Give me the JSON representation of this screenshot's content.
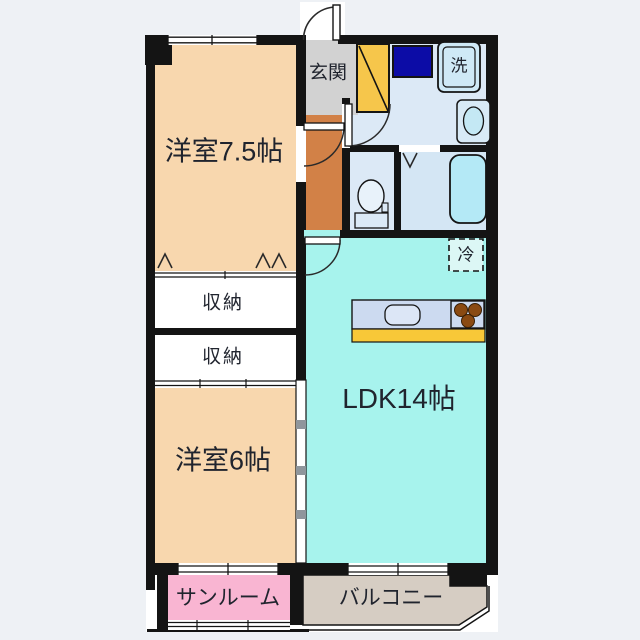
{
  "plan": {
    "type": "apartment-floorplan",
    "rooms": {
      "bedroom_75": {
        "label": "洋室7.5帖",
        "color": "#f8d7ae"
      },
      "entrance": {
        "label": "玄関",
        "color": "#d2d2d2"
      },
      "washer": {
        "label": "洗",
        "color": "#cfe9f6"
      },
      "storage_upper": {
        "label": "収納",
        "color": "#ffffff"
      },
      "storage_lower": {
        "label": "収納",
        "color": "#ffffff"
      },
      "bedroom_6": {
        "label": "洋室6帖",
        "color": "#f8d7ae"
      },
      "ldk": {
        "label": "LDK14帖",
        "color": "#a7f3ed"
      },
      "refrigerator": {
        "label": "冷"
      },
      "sunroom": {
        "label": "サンルーム",
        "color": "#f9b5d2"
      },
      "balcony": {
        "label": "バルコニー",
        "color": "#d6cdc3"
      }
    },
    "colors": {
      "wall": "#141414",
      "background": "#eef1f5",
      "plan_paper": "#ffffff",
      "corridor": "#d28147",
      "wet_area": "#dce9f6",
      "bath_floor": "#d4e6f4",
      "bathtub": "#b4e9f6",
      "shoe_cabinet": "#f6c64b",
      "closet_navy": "#0c0ca6",
      "kitchen_counter": "#ccdaf0",
      "kitchen_strip": "#f8c838",
      "stove_burner": "#8a4a12",
      "text": "#20242e"
    },
    "icons": {
      "washer": "double-bordered square with 洗",
      "washbasin": "rounded square with oval basin",
      "toilet": "oval bowl with tank",
      "bathtub": "rounded rectangle tub",
      "stove": "three brown burner circles",
      "sink": "rounded rectangle in counter",
      "refrigerator": "dashed square with 冷",
      "doors": "quarter-circle swing arcs",
      "closet_doors": "chevron fold marks",
      "shoe_cabinet": "diagonal slash box"
    }
  }
}
